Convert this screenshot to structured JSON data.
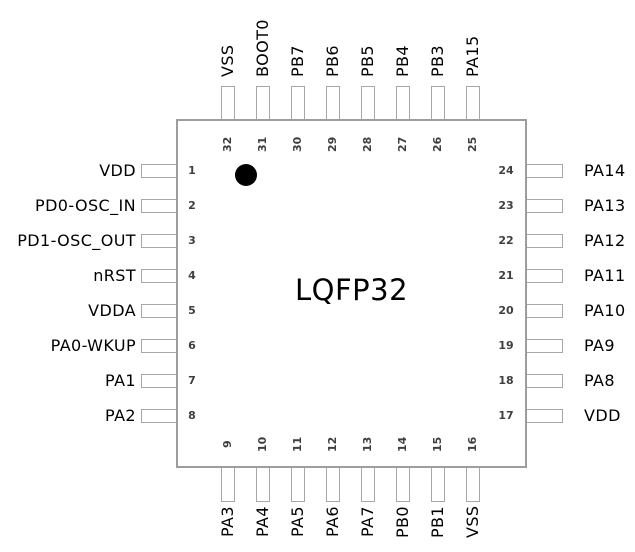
{
  "diagram": {
    "package_label": "LQFP32",
    "pin1_indicator": "black-dot",
    "colors": {
      "background": "#ffffff",
      "outline": "#9d9d9d",
      "stub_outline": "#a7a7a7",
      "pin_number": "#3f3f3f",
      "label_text": "#000000",
      "pin1_dot": "#000000"
    },
    "pins": {
      "left": [
        {
          "number": "1",
          "label": "VDD"
        },
        {
          "number": "2",
          "label": "PD0-OSC_IN"
        },
        {
          "number": "3",
          "label": "PD1-OSC_OUT"
        },
        {
          "number": "4",
          "label": "nRST"
        },
        {
          "number": "5",
          "label": "VDDA"
        },
        {
          "number": "6",
          "label": "PA0-WKUP"
        },
        {
          "number": "7",
          "label": "PA1"
        },
        {
          "number": "8",
          "label": "PA2"
        }
      ],
      "top": [
        {
          "number": "32",
          "label": "VSS"
        },
        {
          "number": "31",
          "label": "BOOT0"
        },
        {
          "number": "30",
          "label": "PB7"
        },
        {
          "number": "29",
          "label": "PB6"
        },
        {
          "number": "28",
          "label": "PB5"
        },
        {
          "number": "27",
          "label": "PB4"
        },
        {
          "number": "26",
          "label": "PB3"
        },
        {
          "number": "25",
          "label": "PA15"
        }
      ],
      "right": [
        {
          "number": "24",
          "label": "PA14"
        },
        {
          "number": "23",
          "label": "PA13"
        },
        {
          "number": "22",
          "label": "PA12"
        },
        {
          "number": "21",
          "label": "PA11"
        },
        {
          "number": "20",
          "label": "PA10"
        },
        {
          "number": "19",
          "label": "PA9"
        },
        {
          "number": "18",
          "label": "PA8"
        },
        {
          "number": "17",
          "label": "VDD"
        }
      ],
      "bottom": [
        {
          "number": "9",
          "label": "PA3"
        },
        {
          "number": "10",
          "label": "PA4"
        },
        {
          "number": "11",
          "label": "PA5"
        },
        {
          "number": "12",
          "label": "PA6"
        },
        {
          "number": "13",
          "label": "PA7"
        },
        {
          "number": "14",
          "label": "PB0"
        },
        {
          "number": "15",
          "label": "PB1"
        },
        {
          "number": "16",
          "label": "VSS"
        }
      ]
    }
  }
}
